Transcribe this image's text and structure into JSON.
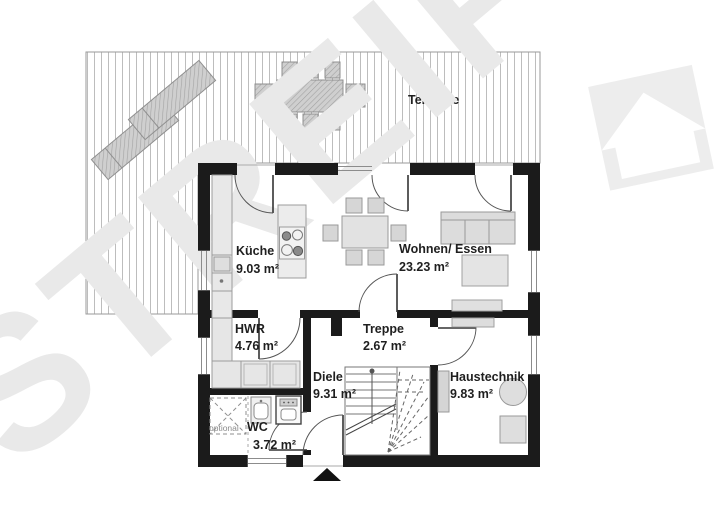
{
  "watermark": {
    "text": "STREIF"
  },
  "terrace": {
    "label": "Terrasse"
  },
  "rooms": [
    {
      "name": "Küche",
      "area": "9.03 m²"
    },
    {
      "name": "Wohnen/ Essen",
      "area": "23.23 m²"
    },
    {
      "name": "HWR",
      "area": "4.76 m²"
    },
    {
      "name": "Treppe",
      "area": "2.67 m²"
    },
    {
      "name": "Diele",
      "area": "9.31 m²"
    },
    {
      "name": "Haustechnik",
      "area": "9.83 m²"
    },
    {
      "name": "WC",
      "area": "3.72 m²",
      "prefix": "optional"
    }
  ],
  "icons": {
    "entrance_arrow": "triangle-up",
    "streif_logo": "house"
  },
  "colors": {
    "wall": "#1b1b1b",
    "furniture_fill": "#e3e3e3",
    "furniture_stroke": "#a0a0a0",
    "deck_line": "#bdbdbd",
    "hatch_fill": "#cfcfcf",
    "watermark": "#e9e9e9",
    "text": "#1f1f1f"
  }
}
